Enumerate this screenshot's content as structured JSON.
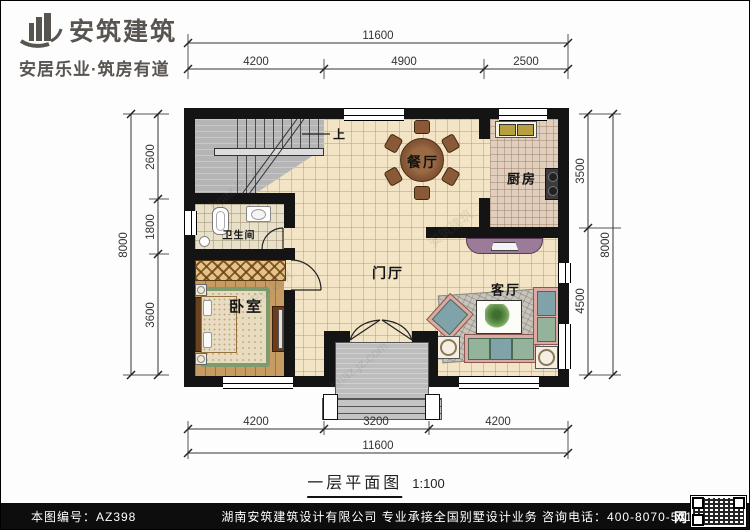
{
  "header": {
    "brand": "安筑建筑",
    "tagline": "安居乐业·筑房有道"
  },
  "plan": {
    "title": "一层平面图",
    "scale": "1:100",
    "rooms": {
      "dining": "餐厅",
      "kitchen": "厨房",
      "bathroom": "卫生间",
      "bedroom": "卧室",
      "foyer": "门厅",
      "living": "客厅",
      "stair_up": "上"
    },
    "dims": {
      "top": {
        "total": "11600",
        "segments": [
          "4200",
          "4900",
          "2500"
        ]
      },
      "bottom": {
        "total": "11600",
        "segments": [
          "4200",
          "3200",
          "4200"
        ]
      },
      "left": {
        "total": "8000",
        "segments": [
          "2600",
          "1800",
          "3600"
        ]
      },
      "right": {
        "total": "8000",
        "segments": [
          "3500",
          "4500"
        ]
      }
    }
  },
  "footer": {
    "sheet_no": "本图编号：AZ398",
    "company": "湖南安筑建筑设计有限公司  专业承接全国别墅设计业务  咨询电话：400-8070-511",
    "net_char": "网"
  },
  "watermark": {
    "site": "hnaz.jz.com",
    "brand": "安筑建筑"
  },
  "colors": {
    "wall": "#141414",
    "tile": "#f2e4c4",
    "wood": "#c69c62",
    "stair": "#b5b5b5",
    "footer_bar": "#0d0d0d"
  }
}
